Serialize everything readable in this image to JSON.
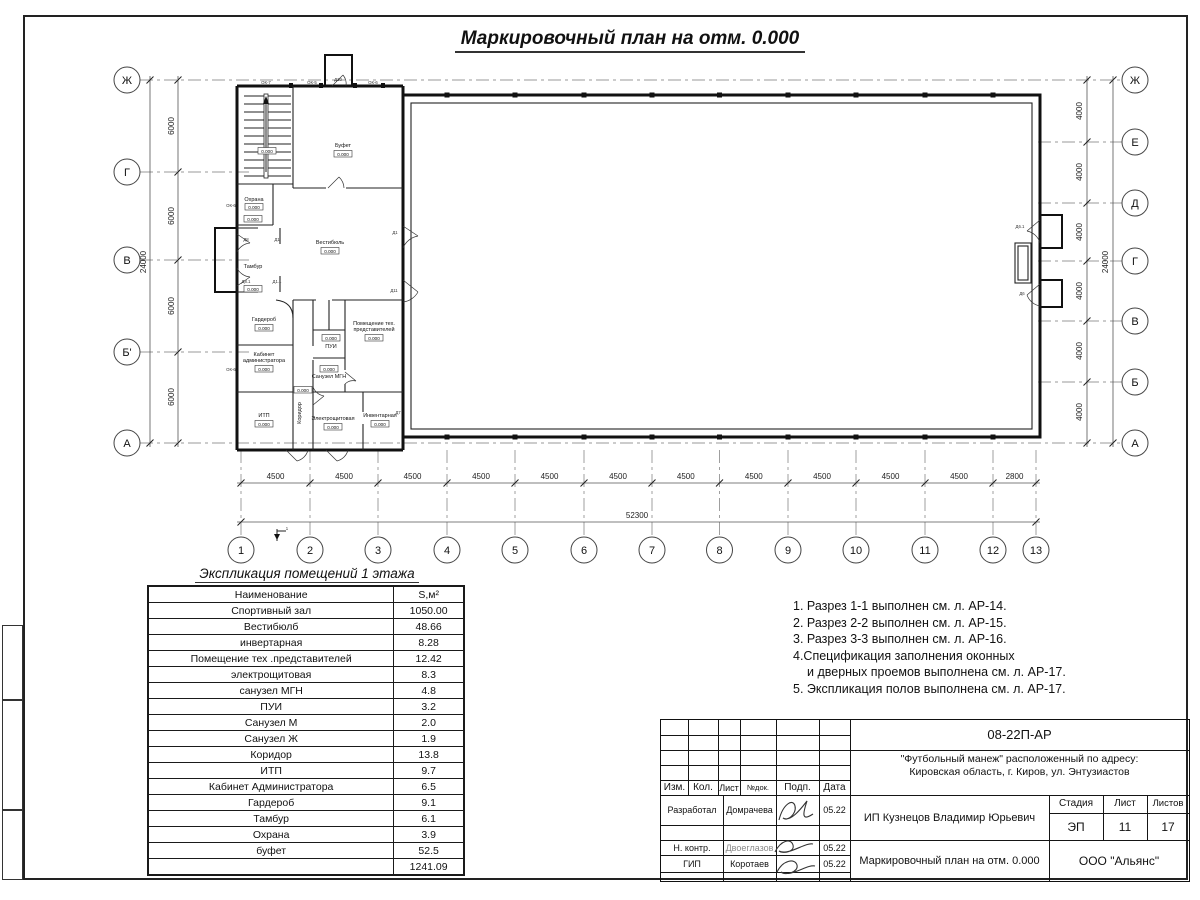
{
  "sheet": {
    "title": "Маркировочный план на отм. 0.000"
  },
  "plan": {
    "left_axes": [
      "Ж",
      "Г",
      "В",
      "Б'",
      "А"
    ],
    "right_axes": [
      "Ж",
      "Е",
      "Д",
      "Г",
      "В",
      "Б",
      "А"
    ],
    "columns": [
      "1",
      "2",
      "3",
      "4",
      "5",
      "6",
      "7",
      "8",
      "9",
      "10",
      "11",
      "12",
      "13"
    ],
    "dims": {
      "bottom_segments": [
        "4500",
        "4500",
        "4500",
        "4500",
        "4500",
        "4500",
        "4500",
        "4500",
        "4500",
        "4500",
        "4500",
        "2800"
      ],
      "bottom_total": "52300",
      "left_segments": [
        "6000",
        "6000",
        "6000",
        "6000"
      ],
      "left_total": "24000",
      "right_segments": [
        "4000",
        "4000",
        "4000",
        "4000",
        "4000",
        "4000"
      ],
      "right_total": "24000"
    },
    "elev": "0.000",
    "section_mark": "1",
    "rooms": {
      "bufet": "Буфет",
      "vestibule": "Вестибюль",
      "ohrana": "Охрана",
      "tambur": "Тамбур",
      "garderob": "Гардероб",
      "kabinet_l1": "Кабинет",
      "kabinet_l2": "администратора",
      "itp": "ИТП",
      "koridor": "Коридор",
      "pui": "ПУИ",
      "su_mgn": "Санузел МГН",
      "tech_l1": "Помещение тех.",
      "tech_l2": "представителей",
      "elektro": "Электрощитовая",
      "invent": "Инвентарная"
    },
    "openings": {
      "ok7": "ОК-7",
      "ok5": "ОК-5",
      "ok6": "ОК-6",
      "d10": "Д10",
      "d1": "Д1",
      "d11": "Д11",
      "d8": "Д8",
      "d8_1": "Д8.1",
      "d1_1": "Д1.1",
      "d6": "Д6",
      "d6_1": "Д6.1",
      "d7": "Д7"
    }
  },
  "schedule": {
    "title": "Экспликация помещений 1 этажа",
    "col_name": "Наименование",
    "col_area": "S,м²",
    "rows": [
      {
        "name": "Спортивный зал",
        "area": "1050.00"
      },
      {
        "name": "Вестибюлб",
        "area": "48.66"
      },
      {
        "name": "инвертарная",
        "area": "8.28"
      },
      {
        "name": "Помещение тех .представителей",
        "area": "12.42"
      },
      {
        "name": "электрощитовая",
        "area": "8.3"
      },
      {
        "name": "санузел МГН",
        "area": "4.8"
      },
      {
        "name": "ПУИ",
        "area": "3.2"
      },
      {
        "name": "Санузел М",
        "area": "2.0"
      },
      {
        "name": "Санузел Ж",
        "area": "1.9"
      },
      {
        "name": "Коридор",
        "area": "13.8"
      },
      {
        "name": "ИТП",
        "area": "9.7"
      },
      {
        "name": "Кабинет Администратора",
        "area": "6.5"
      },
      {
        "name": "Гардероб",
        "area": "9.1"
      },
      {
        "name": "Тамбур",
        "area": "6.1"
      },
      {
        "name": "Охрана",
        "area": "3.9"
      },
      {
        "name": "буфет",
        "area": "52.5"
      }
    ],
    "total": "1241.09"
  },
  "notes": {
    "lines": [
      "1. Разрез 1-1 выполнен см. л. АР-14.",
      "2. Разрез 2-2 выполнен см. л. АР-15.",
      "3. Разрез 3-3 выполнен см. л. АР-16.",
      "4.Спецификация заполнения оконных",
      "и дверных проемов выполнена см. л. АР-17.",
      "5. Экспликация полов выполнена см. л. АР-17."
    ]
  },
  "titleblock": {
    "doc_number": "08-22П-АР",
    "address_line1": "\"Футбольный манеж\" расположенный по адресу:",
    "address_line2": "Кировская область, г. Киров, ул. Энтузиастов",
    "customer": "ИП Кузнецов Владимир Юрьевич",
    "drawing_title": "Маркировочный план на отм. 0.000",
    "company": "ООО \"Альянс\"",
    "stage_label": "Стадия",
    "sheet_label": "Лист",
    "sheets_label": "Листов",
    "stage": "ЭП",
    "sheet": "11",
    "sheets": "17",
    "header_cells": [
      "Изм.",
      "Кол.",
      "Лист",
      "№док.",
      "Подп.",
      "Дата"
    ],
    "roles": [
      {
        "role": "Разработал",
        "name": "Домрачева",
        "date": "05.22"
      },
      {
        "role": "Н. контр.",
        "name": "Двоеглазов",
        "date": "05.22"
      },
      {
        "role": "ГИП",
        "name": "Коротаев",
        "date": "05.22"
      }
    ]
  }
}
